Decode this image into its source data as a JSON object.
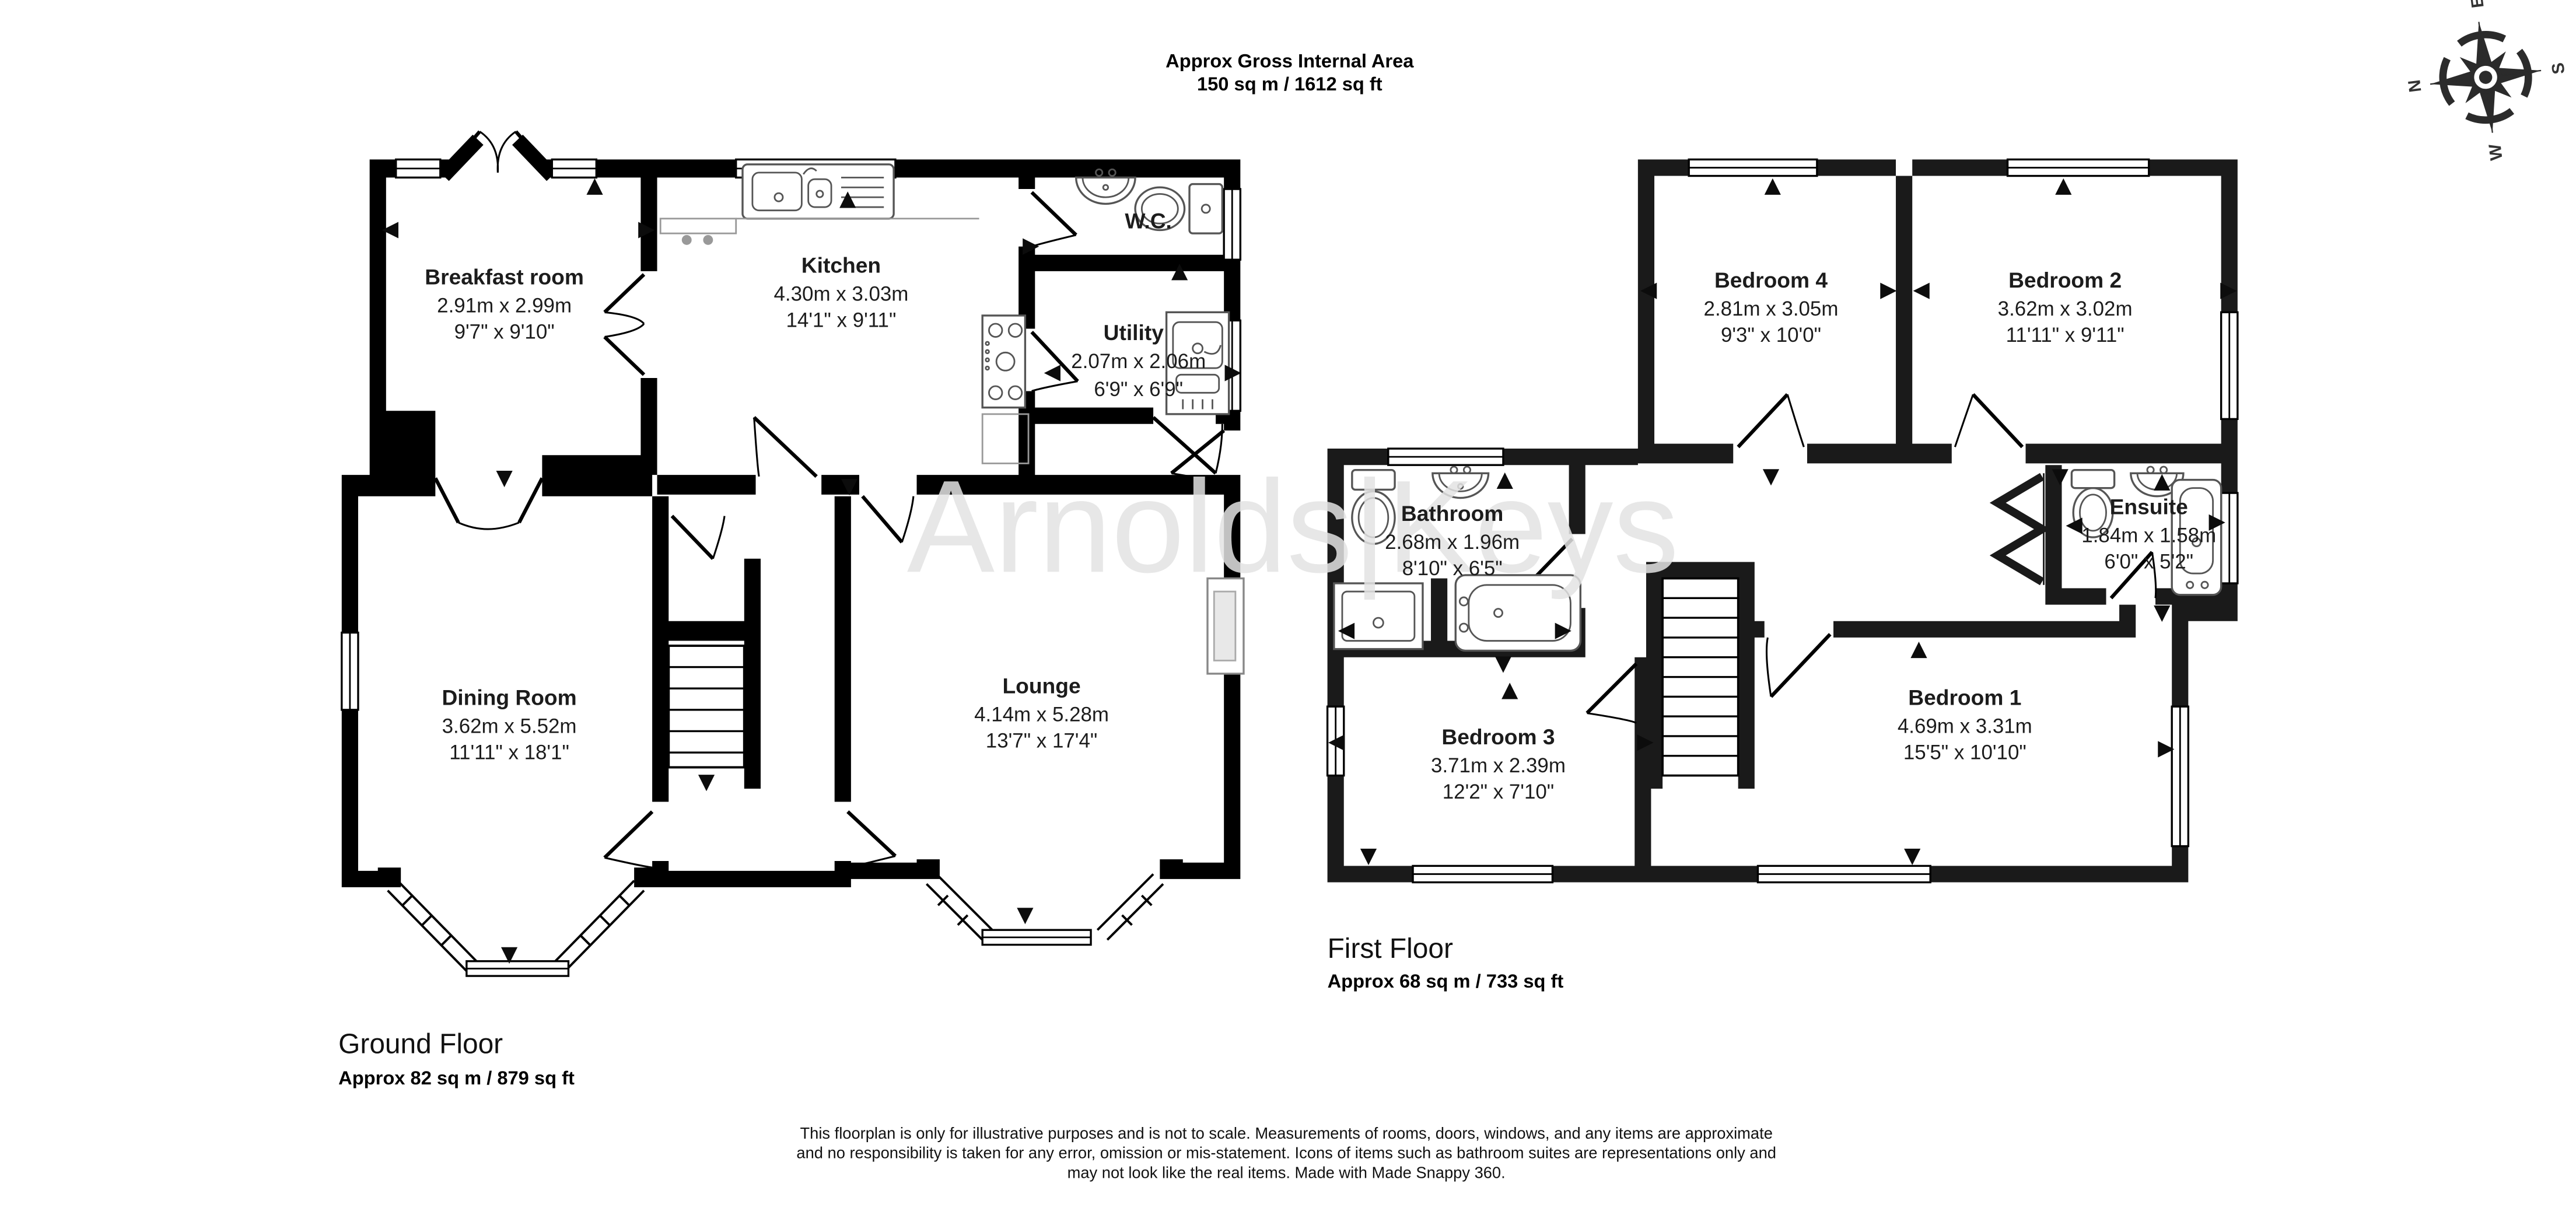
{
  "header": {
    "title_line1": "Approx Gross Internal Area",
    "title_line2": "150 sq m / 1612 sq ft"
  },
  "watermark": "Arnolds|Keys",
  "compass": {
    "n": "N",
    "e": "E",
    "s": "S",
    "w": "W"
  },
  "ground_floor": {
    "label": "Ground Floor",
    "area": "Approx 82 sq m / 879 sq ft",
    "rooms": [
      {
        "name": "Breakfast room",
        "metric": "2.91m x 2.99m",
        "imperial": "9'7\" x 9'10\""
      },
      {
        "name": "Kitchen",
        "metric": "4.30m x 3.03m",
        "imperial": "14'1\" x 9'11\""
      },
      {
        "name": "W.C."
      },
      {
        "name": "Utility",
        "metric": "2.07m x 2.06m",
        "imperial": "6'9\" x 6'9\""
      },
      {
        "name": "Dining Room",
        "metric": "3.62m x 5.52m",
        "imperial": "11'11\" x 18'1\""
      },
      {
        "name": "Lounge",
        "metric": "4.14m x 5.28m",
        "imperial": "13'7\" x 17'4\""
      }
    ]
  },
  "first_floor": {
    "label": "First Floor",
    "area": "Approx 68 sq m / 733 sq ft",
    "rooms": [
      {
        "name": "Bedroom 4",
        "metric": "2.81m x 3.05m",
        "imperial": "9'3\" x 10'0\""
      },
      {
        "name": "Bedroom 2",
        "metric": "3.62m x 3.02m",
        "imperial": "11'11\" x 9'11\""
      },
      {
        "name": "Bathroom",
        "metric": "2.68m x 1.96m",
        "imperial": "8'10\" x 6'5\""
      },
      {
        "name": "Ensuite",
        "metric": "1.84m x 1.58m",
        "imperial": "6'0\" x 5'2\""
      },
      {
        "name": "Bedroom 3",
        "metric": "3.71m x 2.39m",
        "imperial": "12'2\" x 7'10\""
      },
      {
        "name": "Bedroom 1",
        "metric": "4.69m x 3.31m",
        "imperial": "15'5\" x 10'10\""
      }
    ]
  },
  "disclaimer": {
    "line1": "This floorplan is only for illustrative purposes and is not to scale. Measurements of rooms, doors, windows, and any items are approximate",
    "line2": "and no responsibility is taken for any error, omission or mis-statement. Icons of items such as bathroom suites are representations only and",
    "line3": "may not look like the real items. Made with Made Snappy 360."
  }
}
